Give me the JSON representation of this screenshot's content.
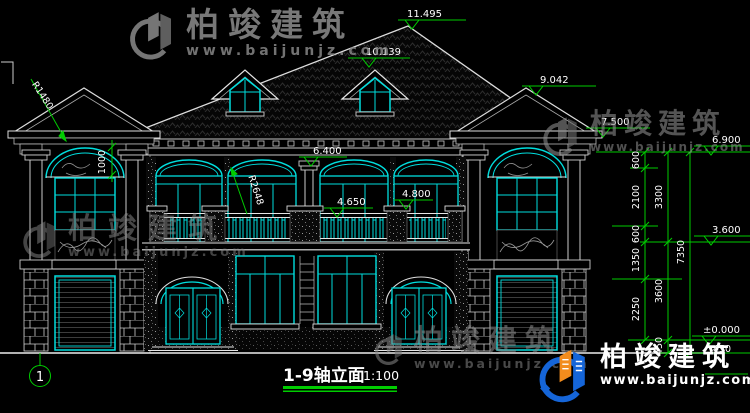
{
  "title": {
    "name": "1-9轴立面",
    "scale": "1:100"
  },
  "axis": {
    "bubble": "1"
  },
  "watermark": {
    "brand": "柏竣建筑",
    "url": "www.baijunjz.com"
  },
  "dims": {
    "ridge": "11.495",
    "dormer_ridge": "10.139",
    "side_roof_ridge": "9.042",
    "porch_cornice": "7.500",
    "eave": "6.900",
    "second_floor": "3.600",
    "ground": "±0.000",
    "column_top": "6.400",
    "rail_top": "4.650",
    "pier_top": "4.800",
    "arch_radius_left": "R1480",
    "arch_radius_center": "R2648",
    "arch_rise": "1000",
    "chain_a": [
      "600",
      "2100",
      "600",
      "1350",
      "2250"
    ],
    "chain_b": [
      "3300",
      "3600",
      "450"
    ],
    "chain_c": [
      "7350"
    ],
    "base_dim": "450"
  },
  "colors": {
    "line_cyan": "#00dede",
    "dim_green": "#00cc00",
    "text_white": "#ffffff",
    "logo_blue": "#1565d8",
    "logo_orange": "#f28c1d"
  }
}
